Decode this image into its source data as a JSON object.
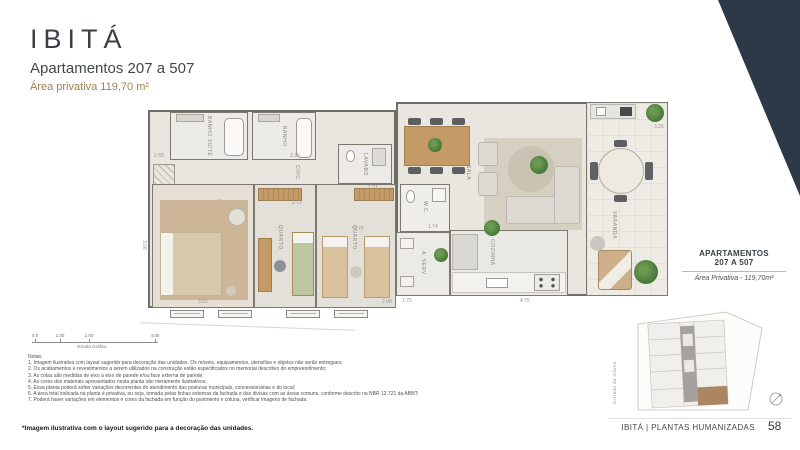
{
  "header": {
    "title": "IBITÁ",
    "subtitle": "Apartamentos 207 a 507",
    "area": "Área privativa 119,70 m²"
  },
  "plan": {
    "rooms": [
      {
        "id": "banho-suite",
        "label": "BANHO SUÍTE"
      },
      {
        "id": "banho",
        "label": "BANHO"
      },
      {
        "id": "circ",
        "label": "CIRC."
      },
      {
        "id": "lavabo",
        "label": "LAVABO"
      },
      {
        "id": "suite",
        "label": "SUÍTE"
      },
      {
        "id": "quarto-1",
        "label": "QUARTO"
      },
      {
        "id": "quarto-2",
        "label": "QUARTO"
      },
      {
        "id": "wc",
        "label": "W.C."
      },
      {
        "id": "a-serv",
        "label": "A. SERV."
      },
      {
        "id": "cozinha",
        "label": "COZINHA"
      },
      {
        "id": "sala",
        "label": "SALA"
      },
      {
        "id": "varanda",
        "label": "VARANDA"
      }
    ],
    "dimensions": [
      "2.55",
      "2.36",
      "3.08",
      "2.72",
      "2.78",
      "1.74",
      "1.71",
      "1.75",
      "4.75",
      "3.26",
      "3.92",
      "2.08"
    ],
    "scale_bar": {
      "ticks": [
        "0.5",
        "1.00",
        "2.00",
        "4.00"
      ],
      "label": "Escala Gráfica"
    }
  },
  "notes": {
    "heading": "Notas:",
    "items": [
      "1. Imagem ilustrativa com layout sugerido para decoração das unidades. Os móveis, equipamentos, utensílios e objetos não serão entregues;",
      "2. Os acabamentos e revestimentos a serem utilizados na construção estão especificados no memorial descritivo do empreendimento;",
      "3. As cotas são medidas de eixo a eixo de parede e/ou face externa de parede;",
      "4. As cores dos materiais apresentados nesta planta são meramente ilustrativos;",
      "5. Essa planta poderá sofrer variações decorrentes do atendimento das posturas municipais, concessionárias e do local;",
      "6. A área total indicada na planta é privativa, ou seja, tomada pelas linhas externas da fachada e das divisas com as áreas comuns, conforme descrito na NBR 12.721 da ABNT;",
      "7. Poderá haver variações em elementos e cores da fachada em função do pavimento e coluna, verificar imagens de fachada."
    ]
  },
  "sidebar": {
    "title_line1": "APARTAMENTOS",
    "title_line2": "207 A 507",
    "area": "Área Privativa - 119,70m²",
    "map": {
      "street": "Estrada da Gávea",
      "highlight_color": "#ab8663"
    }
  },
  "footer": {
    "note": "*Imagem ilustrativa com o layout sugerido para a decoração das unidades.",
    "brand": "IBITÁ | PLANTAS HUMANIZADAS",
    "page_number": "58"
  },
  "colors": {
    "accent_navy": "#2e3947",
    "accent_gold": "#a87e52",
    "wall_gray": "#6f6d68",
    "floor": "#e9e6e0",
    "suite_rug": "#cdb697",
    "highlight_unit": "#ab8663"
  }
}
